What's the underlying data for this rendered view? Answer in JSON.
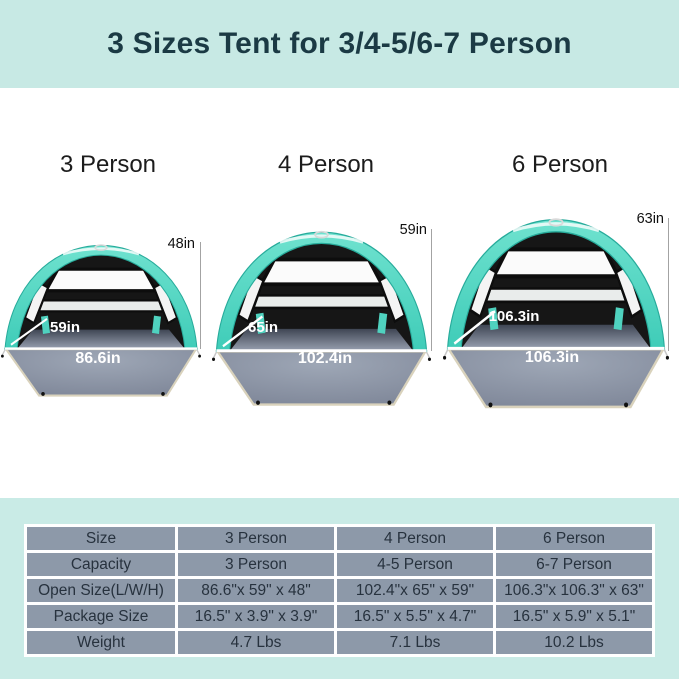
{
  "header": {
    "title": "3 Sizes Tent for 3/4-5/6-7 Person"
  },
  "tents": [
    {
      "name": "3 Person",
      "height": "48in",
      "depth": "59in",
      "width": "86.6in"
    },
    {
      "name": "4 Person",
      "height": "59in",
      "depth": "65in",
      "width": "102.4in"
    },
    {
      "name": "6 Person",
      "height": "63in",
      "depth": "106.3in",
      "width": "106.3in"
    }
  ],
  "spec_table": {
    "rows": [
      {
        "label": "Size",
        "values": [
          "3 Person",
          "4 Person",
          "6 Person"
        ]
      },
      {
        "label": "Capacity",
        "values": [
          "3 Person",
          "4-5 Person",
          "6-7 Person"
        ]
      },
      {
        "label": "Open Size(L/W/H)",
        "values": [
          "86.6\"x 59\" x 48\"",
          "102.4\"x 65\" x 59\"",
          "106.3\"x 106.3\" x 63\""
        ]
      },
      {
        "label": "Package Size",
        "values": [
          "16.5\" x 3.9\" x 3.9\"",
          "16.5\" x 5.5\" x 4.7\"",
          "16.5\" x 5.9\" x 5.1\""
        ]
      },
      {
        "label": "Weight",
        "values": [
          "4.7 Lbs",
          "7.1 Lbs",
          "10.2 Lbs"
        ]
      }
    ]
  },
  "colors": {
    "banner_bg": "#c7e9e4",
    "banner_text": "#1b3a44",
    "tent_canopy": "#4fd7c3",
    "tent_interior": "#161616",
    "floor_gray": "#8d96a7",
    "floor_edge_trim": "#d9d2bc",
    "table_cell_bg": "#8d99a9",
    "table_panel_bg": "#c9ebe6",
    "dimension_text_light": "#ffffff",
    "dimension_text_dark": "#111111"
  }
}
